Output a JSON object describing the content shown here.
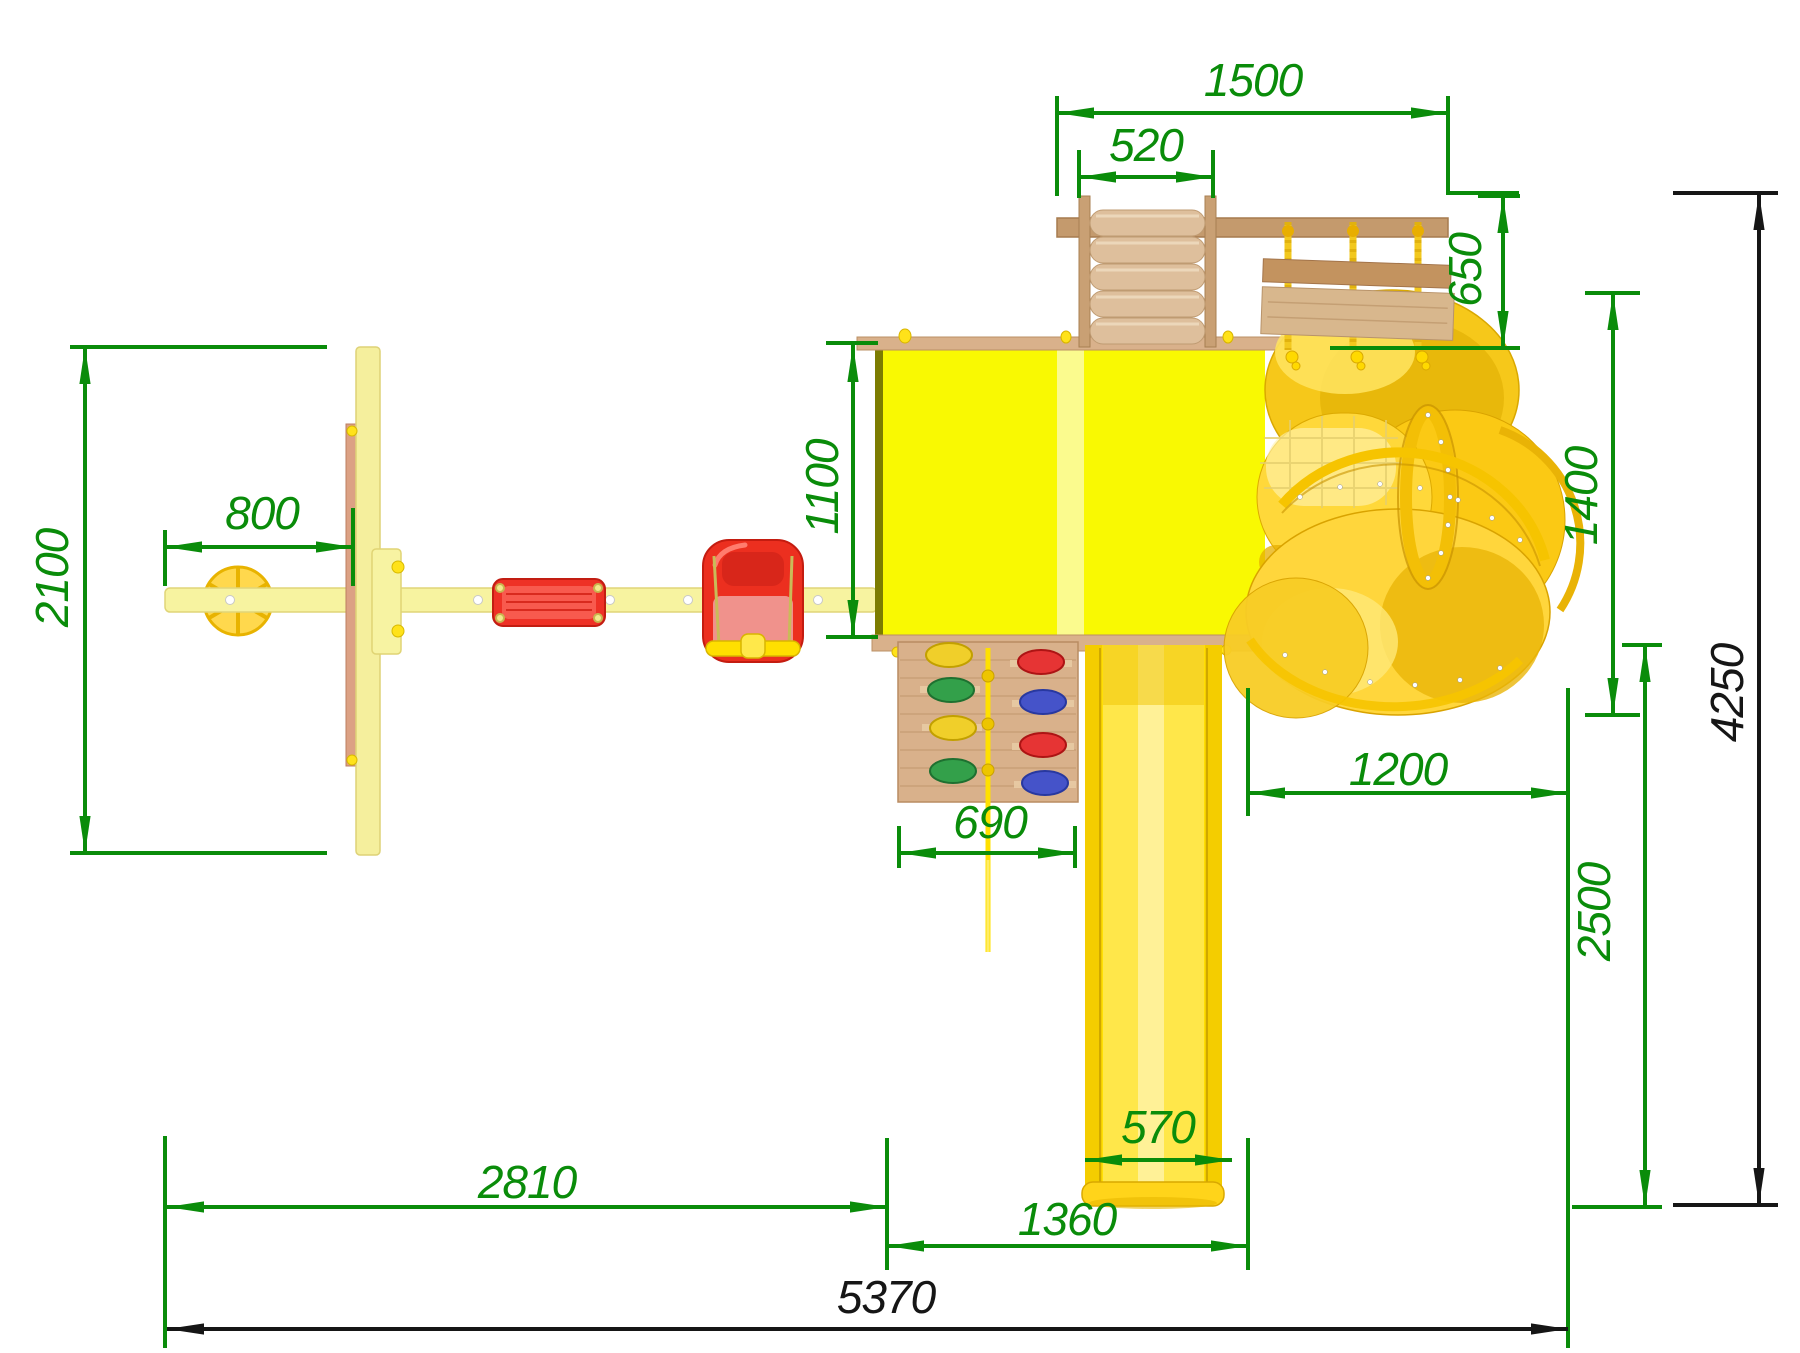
{
  "drawing": {
    "view": "top-view installation drawing of playground set",
    "dims": {
      "upper_walkway_span": "1500",
      "climb_ladder_width": "520",
      "bridge_depth": "650",
      "swing_hanger_offset": "800",
      "swing_frame_length": "2100",
      "platform_depth": "1100",
      "spiral_slide_depth": "1400",
      "spiral_slide_width": "1200",
      "rock_wall_width": "690",
      "slide_exit_depth": "2500",
      "overall_depth": "4250",
      "swing_bay_width": "2810",
      "slide_width": "570",
      "slide_bay_width": "1360",
      "overall_width": "5370"
    },
    "colors": {
      "dimension_green": "#0a8c0a",
      "dimension_black": "#161616",
      "platform_yellow": "#f9f902",
      "tube_slide_gold": "#ffd63c",
      "beam_pale_yellow": "#f7f3a0",
      "wood_tan": "#d9b18b",
      "seat_red": "#ee3126",
      "rope_yellow": "#f2c81e",
      "hold_green": "#33a04a",
      "hold_blue": "#4553c9",
      "background": "#ffffff"
    }
  }
}
